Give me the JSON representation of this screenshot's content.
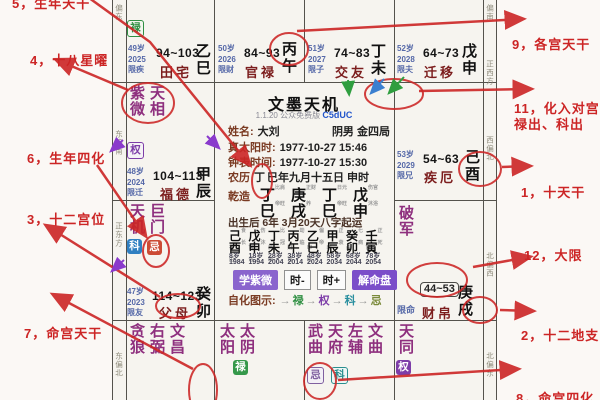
{
  "app": {
    "title": "文墨天机",
    "version": "1.1.20 公众免费版",
    "build": "C5dUC"
  },
  "profile": {
    "name_label": "姓名:",
    "name": "大刘",
    "gender_bureau": "阴男 金四局",
    "true_solar_label": "真太阳时:",
    "true_solar": "1977-10-27  15:46",
    "clock_label": "钟表时间:",
    "clock": "1977-10-27  15:30",
    "lunar_label": "农历",
    "lunar_year_stem": "丁",
    "lunar_rest": "巳年九月十五日 申时",
    "qianzao_label": "乾造"
  },
  "bazi": {
    "stems": [
      "丁",
      "庚",
      "丁",
      "戊"
    ],
    "stem_notes": [
      "比肩",
      "正财",
      "日元",
      "伤官"
    ],
    "branches": [
      "巳",
      "戌",
      "巳",
      "申"
    ],
    "branch_notes": [
      "帝旺",
      "养",
      "帝旺",
      "沐浴"
    ],
    "qiyun": "出生后 6年 3月20天八字起运"
  },
  "dayun": {
    "stems": [
      "己",
      "戊",
      "丁",
      "丙",
      "乙",
      "甲",
      "癸",
      "壬"
    ],
    "stem_notes": [
      "食神",
      "伤官",
      "比肩",
      "劫财",
      "偏印",
      "正印",
      "七杀",
      "正官"
    ],
    "branches": [
      "酉",
      "申",
      "未",
      "午",
      "巳",
      "辰",
      "卯",
      "寅"
    ],
    "branch_notes": [
      "长生",
      "沐浴",
      "冠带",
      "临官",
      "帝旺",
      "衰",
      "病",
      "死"
    ],
    "ages": [
      "8岁",
      "18岁",
      "28岁",
      "38岁",
      "48岁",
      "58岁",
      "68岁",
      "78岁"
    ],
    "years": [
      "1984",
      "1994",
      "2004",
      "2014",
      "2024",
      "2034",
      "2044",
      "2054"
    ]
  },
  "toolbar": {
    "learn": "学紫微",
    "time_minus": "时-",
    "time_plus": "时+",
    "decode": "解命盘"
  },
  "zihua_legend": {
    "label": "自化图示:",
    "arrow": "→",
    "items": [
      "禄",
      "权",
      "科",
      "忌"
    ]
  },
  "palaces": {
    "tianzhai": {
      "badge": "禄",
      "range": "94~103",
      "name": "田宅",
      "stem": "乙",
      "branch": "巳",
      "info": [
        "49岁",
        "2025",
        "限疾"
      ]
    },
    "guanlu": {
      "range": "84~93",
      "name": "官禄",
      "stem": "丙",
      "branch": "午",
      "info": [
        "50岁",
        "2026",
        "限财"
      ]
    },
    "jiaoyou": {
      "range": "74~83",
      "name": "交友",
      "stem": "丁",
      "branch": "未",
      "info": [
        "51岁",
        "2027",
        "限子"
      ]
    },
    "qianyi": {
      "range": "64~73",
      "name": "迁移",
      "stem": "戊",
      "branch": "申",
      "info": [
        "52岁",
        "2028",
        "限夫"
      ]
    },
    "fude": {
      "stars": [
        "紫微",
        "天相"
      ],
      "badge": "权",
      "range": "104~113",
      "name": "福德",
      "stem": "甲",
      "branch": "辰",
      "info": [
        "48岁",
        "2024",
        "限迁"
      ]
    },
    "fumu": {
      "stars": [
        "天机",
        "巨门"
      ],
      "badges": [
        "科",
        "忌"
      ],
      "range": "114~123",
      "name": "父母",
      "stem": "癸",
      "branch": "卯",
      "info": [
        "47岁",
        "2023",
        "限友"
      ]
    },
    "jie": {
      "range": "54~63",
      "name": "疾厄",
      "stem": "己",
      "branch": "酉",
      "info": [
        "53岁",
        "2029",
        "限兄"
      ]
    },
    "caibo": {
      "stars": [
        "破军"
      ],
      "range": "44~53",
      "name": "财帛",
      "stem": "庚",
      "branch": "戌",
      "info": [
        "限命"
      ]
    },
    "yin": {
      "stars": [
        "贪狼",
        "右弼",
        "文昌"
      ]
    },
    "chou": {
      "stars": [
        "太阳",
        "太阴"
      ],
      "badge": "禄"
    },
    "zi": {
      "stars": [
        "武曲",
        "天府",
        "左辅",
        "文曲"
      ],
      "badges": [
        "忌",
        "科"
      ]
    },
    "hai": {
      "stars": [
        "天同"
      ],
      "badge": "权"
    }
  },
  "compass": {
    "left": [
      "偏东",
      "东偏南",
      "正东方",
      "东偏北"
    ],
    "right": [
      "偏南",
      "正西方",
      "西偏北",
      "北偏西",
      "北偏东"
    ]
  },
  "annotations": {
    "a1": "1，十天干",
    "a2": "2，十二地支",
    "a3": "3，十二宫位",
    "a4": "4，十八星曜",
    "a5": "5，生年天干",
    "a6": "6，生年四化",
    "a7": "7，命宫天干",
    "a8": "8，命宫四化",
    "a9": "9，各宫天干",
    "a11a": "11，化入对宫",
    "a11b": "禄出、科出",
    "a12": "12，大限"
  },
  "colors": {
    "annotation_red": "#cc2525",
    "accent_purple": "#8a64cd",
    "lu_green": "#35984a",
    "quan_purple": "#7d3da8",
    "ke_blue": "#2f7fc1",
    "ji_red": "#cc4b35"
  }
}
